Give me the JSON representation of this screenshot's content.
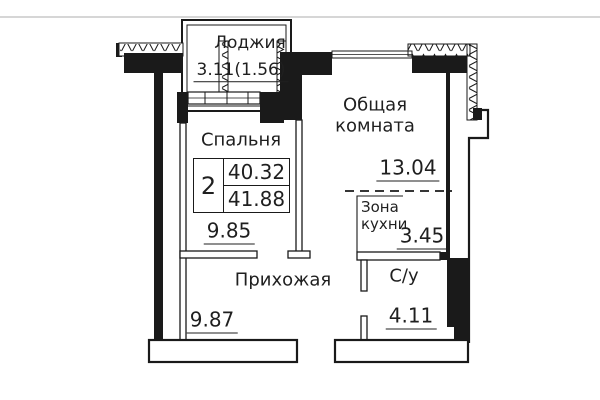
{
  "colors": {
    "wall": "#1a1a1a",
    "text": "#1f1f1f",
    "faint_line": "#c9c9c9",
    "background": "#ffffff"
  },
  "rooms": {
    "loggia": {
      "label": "Лоджия",
      "area": "3.11(1.56)"
    },
    "bedroom": {
      "label": "Спальня",
      "area": "9.85"
    },
    "living": {
      "label_line1": "Общая",
      "label_line2": "комната",
      "area": "13.04"
    },
    "kitchen": {
      "label_line1": "Зона",
      "label_line2": "кухни",
      "area": "3.45"
    },
    "hallway": {
      "label": "Прихожая",
      "area": "9.87"
    },
    "bathroom": {
      "label": "С/у",
      "area": "4.11"
    }
  },
  "stamp": {
    "rooms_count": "2",
    "area_top": "40.32",
    "area_bottom": "41.88"
  }
}
